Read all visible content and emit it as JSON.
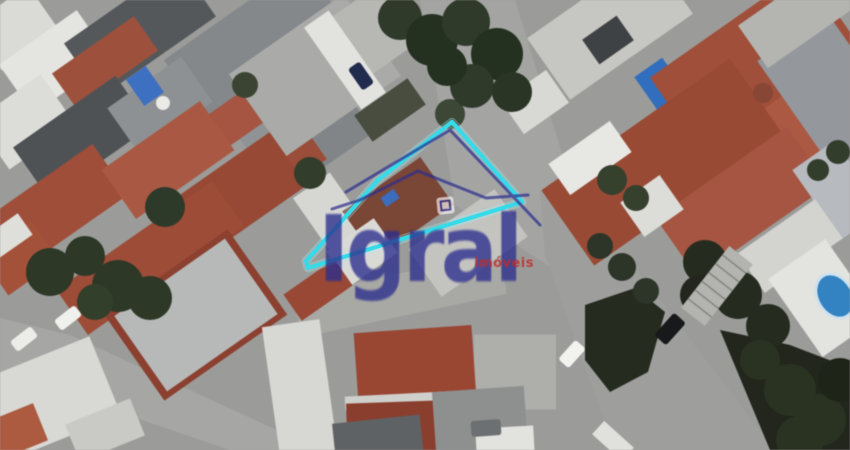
{
  "canvas": {
    "width": 850,
    "height": 450,
    "background": "#9b9c9a"
  },
  "watermark": {
    "brand": "Igral",
    "tagline": "imóveis",
    "brand_color": "#2c2e8e",
    "accent_color": "#c22a28",
    "rooflines": [
      "346,192 450,130 540,225",
      "332,209 360,200 418,171 486,198 528,195"
    ],
    "badge": {
      "x": 437,
      "y": 197,
      "w": 17,
      "h": 17,
      "rot": -6
    }
  },
  "lot_overlay": {
    "color": "#36dbe9",
    "glow_color": "#9af1f8",
    "stroke_width": 4,
    "points": "452,122 522,202 308,268 306,261 317,249 378,180"
  },
  "scene": {
    "streets": [
      {
        "id": "north",
        "points": "420,0 515,0 590,245 555,270 455,205 432,60",
        "color": "#a4a5a3"
      },
      {
        "id": "east",
        "points": "540,190 595,215 775,450 615,450 545,255",
        "color": "#9e9f9d"
      },
      {
        "id": "southwest",
        "points": "0,318 70,335 320,450 230,450 0,372",
        "color": "#a6a7a5"
      }
    ],
    "roofs": [
      [
        15,
        28,
        70,
        55,
        -35,
        "#dadad6"
      ],
      [
        55,
        62,
        95,
        60,
        -35,
        "#e4e4e0"
      ],
      [
        140,
        30,
        140,
        65,
        -35,
        "#55585b"
      ],
      [
        255,
        42,
        170,
        75,
        -35,
        "#85888b"
      ],
      [
        105,
        62,
        100,
        42,
        -35,
        "#a0503a"
      ],
      [
        272,
        120,
        75,
        70,
        -35,
        "#909395"
      ],
      [
        228,
        124,
        65,
        38,
        -35,
        "#a85440"
      ],
      [
        25,
        122,
        80,
        60,
        -35,
        "#dcdcd8"
      ],
      [
        82,
        137,
        125,
        62,
        -35,
        "#4e5255"
      ],
      [
        160,
        105,
        90,
        55,
        -35,
        "#8e9193"
      ],
      [
        322,
        132,
        85,
        60,
        -35,
        "#828587"
      ],
      [
        286,
        162,
        70,
        42,
        -35,
        "#9d4c37"
      ],
      [
        315,
        75,
        140,
        100,
        -35,
        "#aaaba9"
      ],
      [
        370,
        33,
        85,
        70,
        -35,
        "#b7b8b4"
      ],
      [
        345,
        60,
        30,
        100,
        -35,
        "#e2e2de"
      ],
      [
        390,
        110,
        65,
        32,
        -35,
        "#484d3f"
      ],
      [
        145,
        86,
        24,
        32,
        -35,
        "#3b70c6"
      ],
      [
        535,
        102,
        55,
        40,
        -35,
        "#d8d8d4"
      ],
      [
        55,
        208,
        135,
        62,
        -35,
        "#a24d37"
      ],
      [
        168,
        160,
        120,
        60,
        -35,
        "#ac5841"
      ],
      [
        235,
        196,
        130,
        65,
        -35,
        "#9a4833"
      ],
      [
        20,
        258,
        62,
        48,
        -35,
        "#a85038"
      ],
      [
        8,
        236,
        42,
        26,
        -35,
        "#dededa"
      ],
      [
        150,
        258,
        190,
        55,
        -35,
        "#a04b36"
      ],
      [
        196,
        315,
        150,
        104,
        -35,
        "#8e3f2e"
      ],
      [
        196,
        315,
        135,
        92,
        -35,
        "#b6b9b8"
      ],
      [
        45,
        400,
        130,
        85,
        -22,
        "#d8d8d4"
      ],
      [
        15,
        432,
        55,
        40,
        -22,
        "#b05a3e"
      ],
      [
        105,
        430,
        70,
        40,
        -22,
        "#c9c9c5"
      ],
      [
        610,
        26,
        150,
        75,
        -35,
        "#c6c6c2"
      ],
      [
        608,
        40,
        42,
        30,
        -35,
        "#3f4244"
      ],
      [
        662,
        87,
        34,
        48,
        -35,
        "#2e6ec2"
      ],
      [
        755,
        62,
        190,
        95,
        -35,
        "#a24e38"
      ],
      [
        802,
        132,
        165,
        82,
        -35,
        "#ae5841"
      ],
      [
        662,
        162,
        230,
        92,
        -35,
        "#9c4933"
      ],
      [
        742,
        202,
        160,
        72,
        -35,
        "#a85440"
      ],
      [
        590,
        158,
        75,
        38,
        -35,
        "#e7e7e3"
      ],
      [
        652,
        206,
        48,
        42,
        -35,
        "#dcdcd8"
      ],
      [
        828,
        88,
        85,
        125,
        -35,
        "#94979c"
      ],
      [
        838,
        190,
        52,
        85,
        -35,
        "#b7babe"
      ],
      [
        800,
        14,
        115,
        52,
        -35,
        "#b4b5b1"
      ],
      [
        790,
        246,
        95,
        48,
        -35,
        "#d3d3cf"
      ],
      [
        824,
        298,
        70,
        95,
        -35,
        "#e3e3df"
      ],
      [
        330,
        212,
        45,
        65,
        -35,
        "#d6d6d2"
      ],
      [
        400,
        295,
        210,
        42,
        -12,
        "#a8a8a4"
      ],
      [
        398,
        208,
        95,
        58,
        -35,
        "#7c4535"
      ],
      [
        468,
        243,
        105,
        58,
        -35,
        "#c3c3bf"
      ],
      [
        362,
        252,
        58,
        42,
        -35,
        "#d9d9d5"
      ],
      [
        390,
        198,
        16,
        11,
        -35,
        "#3a6cc0"
      ],
      [
        318,
        290,
        62,
        32,
        -35,
        "#9c4733"
      ],
      [
        300,
        390,
        58,
        135,
        -8,
        "#d7d7d3"
      ],
      [
        515,
        372,
        82,
        75,
        0,
        "#aeaeaa"
      ],
      [
        415,
        365,
        118,
        72,
        -4,
        "#9c4531"
      ],
      [
        415,
        400,
        140,
        14,
        -3,
        "#cfcfcb"
      ],
      [
        422,
        430,
        150,
        58,
        -2,
        "#8d3d2c"
      ],
      [
        378,
        440,
        88,
        42,
        -6,
        "#5f6265"
      ],
      [
        480,
        420,
        92,
        62,
        -4,
        "#8d908f"
      ],
      [
        505,
        442,
        58,
        30,
        -3,
        "#e2e2de"
      ],
      [
        613,
        441,
        40,
        18,
        42,
        "#e0e0dc"
      ]
    ],
    "veg_masses": [
      {
        "points": "720,330 790,345 850,368 850,450 770,450",
        "color": "#22261c"
      },
      {
        "points": "585,305 635,288 665,312 648,372 610,392 585,360",
        "color": "#262b1f"
      }
    ],
    "trees": [
      [
        50,
        272,
        24,
        "#2d3826"
      ],
      [
        85,
        256,
        20,
        "#2d3826"
      ],
      [
        118,
        286,
        26,
        "#2d3826"
      ],
      [
        150,
        298,
        22,
        "#2d3826"
      ],
      [
        95,
        302,
        18,
        "#32402a"
      ],
      [
        165,
        207,
        20,
        "#2e3a28"
      ],
      [
        310,
        173,
        16,
        "#333d2b"
      ],
      [
        450,
        114,
        15,
        "#3c4734"
      ],
      [
        245,
        85,
        13,
        "#3b4431"
      ],
      [
        400,
        18,
        22,
        "#2f3a2a"
      ],
      [
        432,
        40,
        26,
        "#24301f"
      ],
      [
        466,
        22,
        24,
        "#2f3a2a"
      ],
      [
        497,
        54,
        26,
        "#24301f"
      ],
      [
        472,
        86,
        22,
        "#2f3a2a"
      ],
      [
        512,
        92,
        20,
        "#2a3524"
      ],
      [
        447,
        66,
        20,
        "#24301f"
      ],
      [
        600,
        246,
        13,
        "#2c3526"
      ],
      [
        622,
        267,
        14,
        "#2c3526"
      ],
      [
        646,
        291,
        13,
        "#2c3526"
      ],
      [
        612,
        180,
        15,
        "#35402c"
      ],
      [
        636,
        198,
        13,
        "#35402c"
      ],
      [
        705,
        262,
        22,
        "#262b1f"
      ],
      [
        738,
        295,
        24,
        "#262b1f"
      ],
      [
        768,
        326,
        22,
        "#262b1f"
      ],
      [
        700,
        295,
        20,
        "#22261c"
      ],
      [
        790,
        390,
        26,
        "#2a3321"
      ],
      [
        820,
        420,
        26,
        "#2a3321"
      ],
      [
        760,
        360,
        20,
        "#2a3321"
      ],
      [
        840,
        380,
        22,
        "#1f2418"
      ],
      [
        800,
        440,
        24,
        "#2a3321"
      ],
      [
        838,
        152,
        12,
        "#333d2b"
      ],
      [
        818,
        170,
        11,
        "#333d2b"
      ]
    ],
    "stairs": {
      "cx": 717,
      "cy": 286,
      "w": 30,
      "h": 78,
      "rot": 38,
      "steps": 6,
      "color": "#b3b3af",
      "line_color": "#84847f"
    },
    "pool": {
      "cx": 835,
      "cy": 296,
      "rx": 16,
      "ry": 22,
      "rot": -30,
      "color": "#2f84c6",
      "rim_color": "#cfe2f0"
    },
    "tanks": [
      [
        163,
        103,
        7,
        "#eaeae6"
      ],
      [
        763,
        93,
        10,
        "#8a4535"
      ]
    ],
    "cars": [
      [
        68,
        318,
        26,
        13,
        -38,
        "#f0f0ec"
      ],
      [
        24,
        339,
        26,
        13,
        -38,
        "#ecece8"
      ],
      [
        361,
        76,
        14,
        26,
        -35,
        "#202b50"
      ],
      [
        572,
        354,
        14,
        26,
        42,
        "#f2f2ee"
      ],
      [
        670,
        329,
        16,
        30,
        42,
        "#17191b"
      ],
      [
        486,
        428,
        30,
        16,
        -4,
        "#6d7072"
      ]
    ]
  }
}
